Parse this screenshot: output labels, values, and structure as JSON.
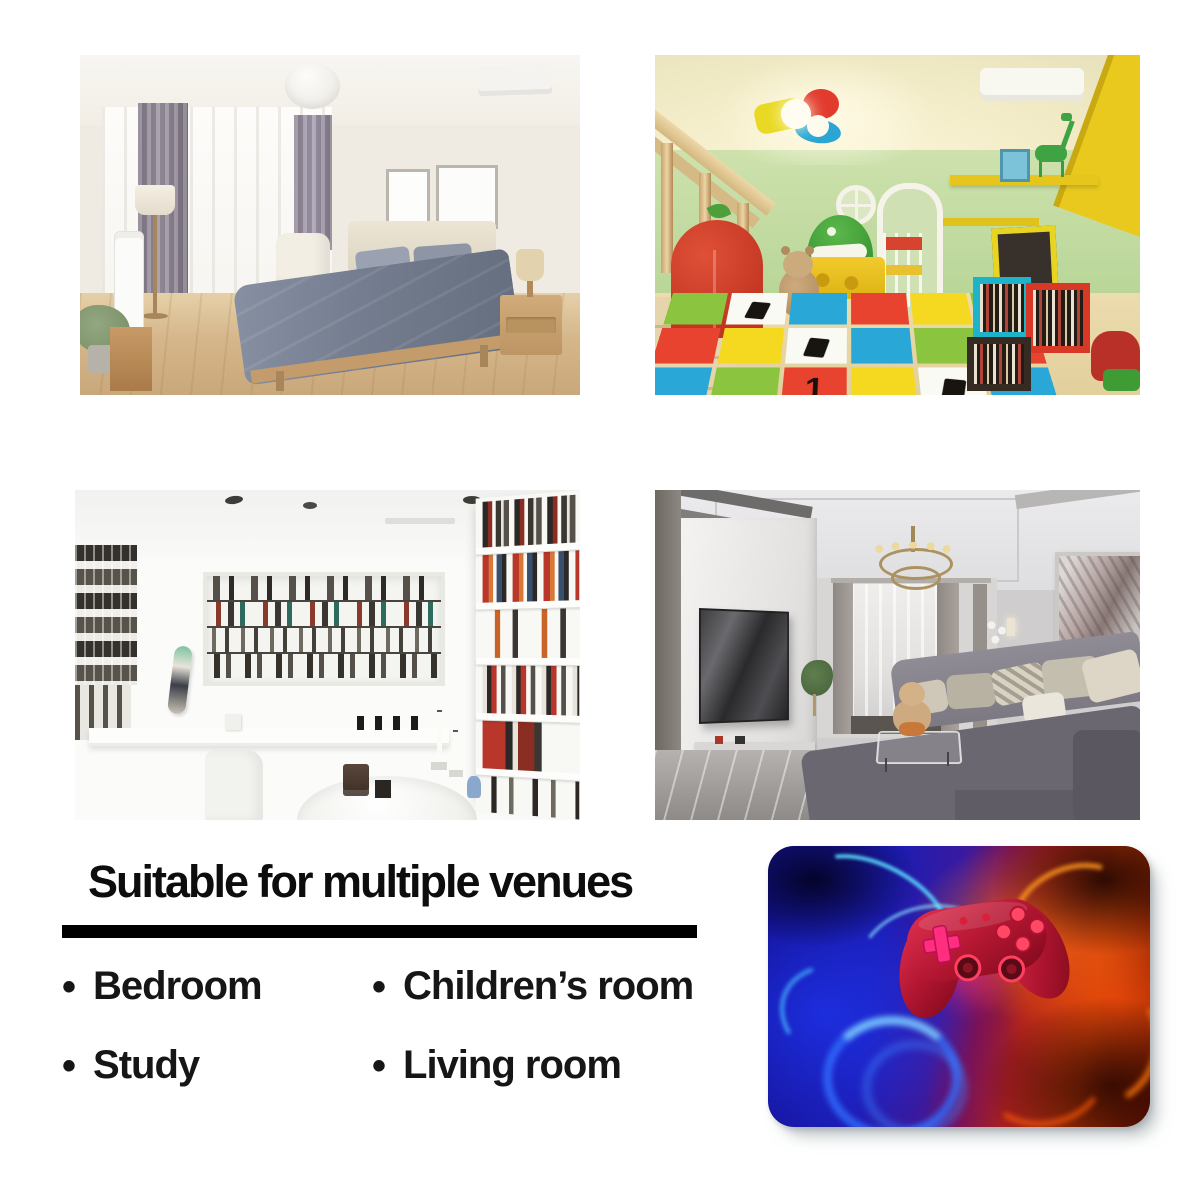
{
  "heading": {
    "title": "Suitable for multiple venues"
  },
  "list": {
    "bullet": "•",
    "items": [
      {
        "label": "Bedroom"
      },
      {
        "label": "Children’s room"
      },
      {
        "label": "Study"
      },
      {
        "label": "Living room"
      }
    ]
  },
  "product": {
    "mat_glyph": "1",
    "palette": {
      "divider": "#000000",
      "text": "#161616",
      "pad_blue": "#1c1cb4",
      "pad_red": "#b43508",
      "pad_cyan": "#5ad8ff",
      "pad_magenta": "#ff2e7e",
      "controller_body": "#c41f3a"
    }
  }
}
